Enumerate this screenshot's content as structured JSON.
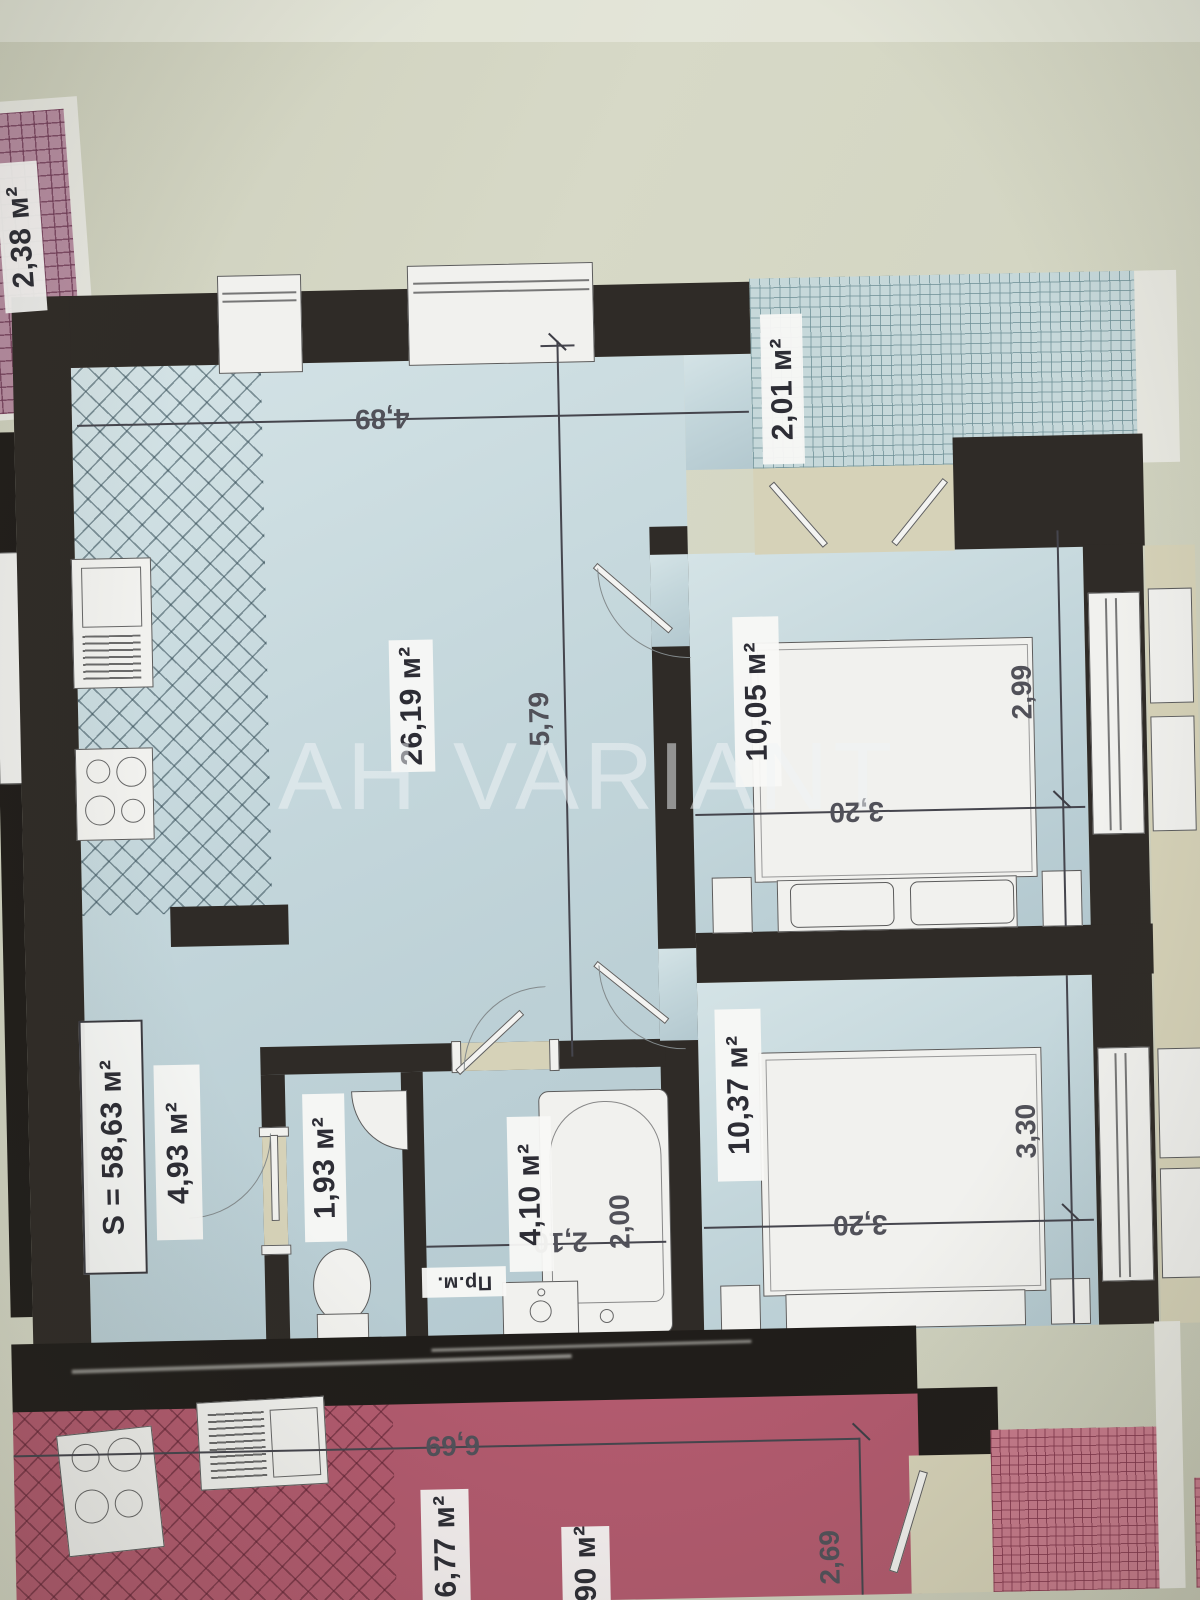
{
  "watermark": "АН VARIANT",
  "plan": {
    "total_area_label": "S = 58,63 м²",
    "rooms": {
      "living": "26,19 м²",
      "bedroom_top": "10,05 м²",
      "bedroom_bottom": "10,37 м²",
      "hallway": "4,93 м²",
      "wc": "1,93 м²",
      "bathroom": "4,10 м²",
      "balcony_right": "2,01 м²",
      "balcony_left": "2,38 м²"
    },
    "dims": {
      "living_w": "4,89",
      "living_h": "5,79",
      "bed1_h": "2,99",
      "bed1_w": "3,20",
      "bed2_h": "3,30",
      "bed2_w": "3,20",
      "bath_w": "2,10",
      "tub_l": "2,00"
    },
    "washer_label": "Пр.м."
  },
  "neighbor": {
    "room_a": "6,77 м²",
    "room_b": "90 м²",
    "dim_w": "6,69",
    "dim_h": "2,69"
  }
}
